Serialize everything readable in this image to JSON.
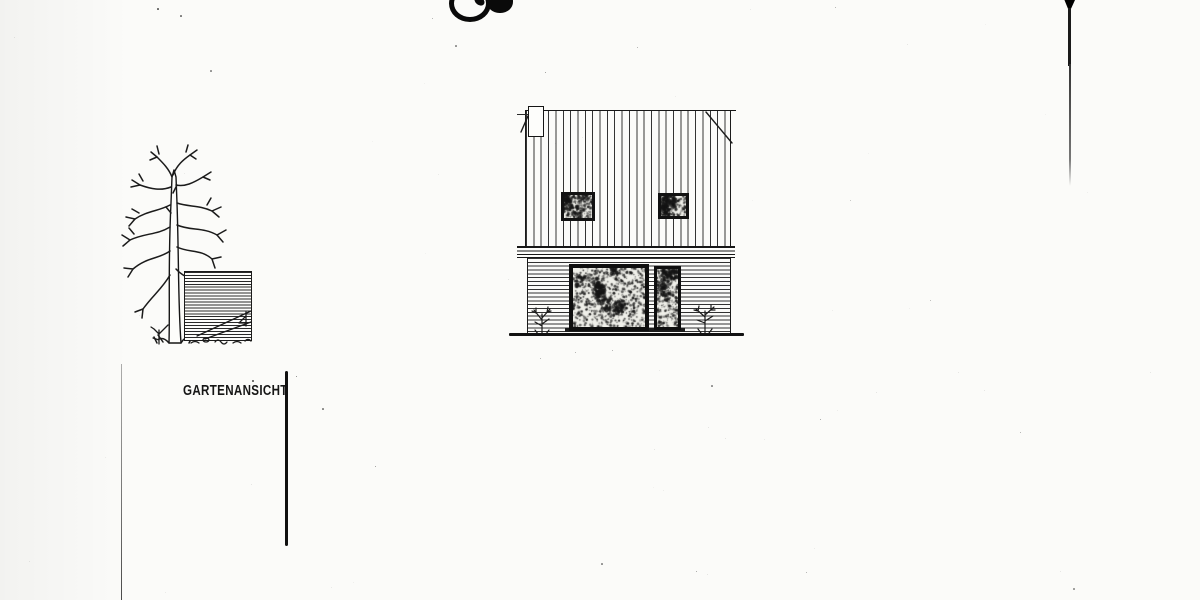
{
  "page": {
    "paper_color": "#fbfbf9",
    "ink_color": "#1b1b1b",
    "width": 1200,
    "height": 600
  },
  "drawing": {
    "caption": "GARTENANSICHT",
    "elements": {
      "tree": "bare-deciduous-tree",
      "fence_panel": "horizontal-board-fence",
      "house": "two-story-house-elevation",
      "upper_cladding": "vertical-boarding",
      "lower_cladding": "horizontal-boarding",
      "chimney": "chimney-stack-left",
      "upper_windows_count": 2,
      "ground_floor_openings": [
        "picture-window",
        "glazed-door"
      ],
      "shrubs_count": 4
    }
  },
  "scan_artifacts": {
    "top_edge_marks": [
      "arc-mark",
      "ink-blob"
    ],
    "vertical_scan_line_right": {
      "x": 1068,
      "from_y": 0,
      "to_y": 186
    },
    "fold_line_left": {
      "x": 121,
      "from_y": 364,
      "to_y": 600
    },
    "section_line": {
      "x": 286,
      "from_y": 371,
      "to_y": 546
    },
    "specks": [
      [
        157,
        8,
        1.5,
        0.7
      ],
      [
        180,
        15,
        1.5,
        0.6
      ],
      [
        210,
        70,
        1.5,
        0.5
      ],
      [
        455,
        45,
        1.5,
        0.5
      ],
      [
        545,
        72,
        1.4,
        0.5
      ],
      [
        637,
        47,
        1.2,
        0.4
      ],
      [
        711,
        385,
        1.5,
        0.5
      ],
      [
        322,
        408,
        1.5,
        0.55
      ],
      [
        375,
        466,
        1.4,
        0.5
      ],
      [
        820,
        419,
        1.4,
        0.45
      ],
      [
        1020,
        432,
        1.2,
        0.4
      ],
      [
        601,
        563,
        1.5,
        0.5
      ],
      [
        696,
        571,
        1.4,
        0.45
      ],
      [
        806,
        572,
        1.3,
        0.4
      ],
      [
        252,
        380,
        2,
        0.8
      ],
      [
        296,
        376,
        1.3,
        0.6
      ],
      [
        1073,
        588,
        1.8,
        0.5
      ],
      [
        930,
        300,
        1.2,
        0.35
      ],
      [
        850,
        200,
        1.2,
        0.3
      ],
      [
        540,
        358,
        1.3,
        0.4
      ],
      [
        575,
        352,
        1.2,
        0.4
      ],
      [
        612,
        350,
        1.3,
        0.4
      ],
      [
        835,
        7,
        1.3,
        0.4
      ],
      [
        432,
        18,
        1.2,
        0.4
      ]
    ]
  }
}
